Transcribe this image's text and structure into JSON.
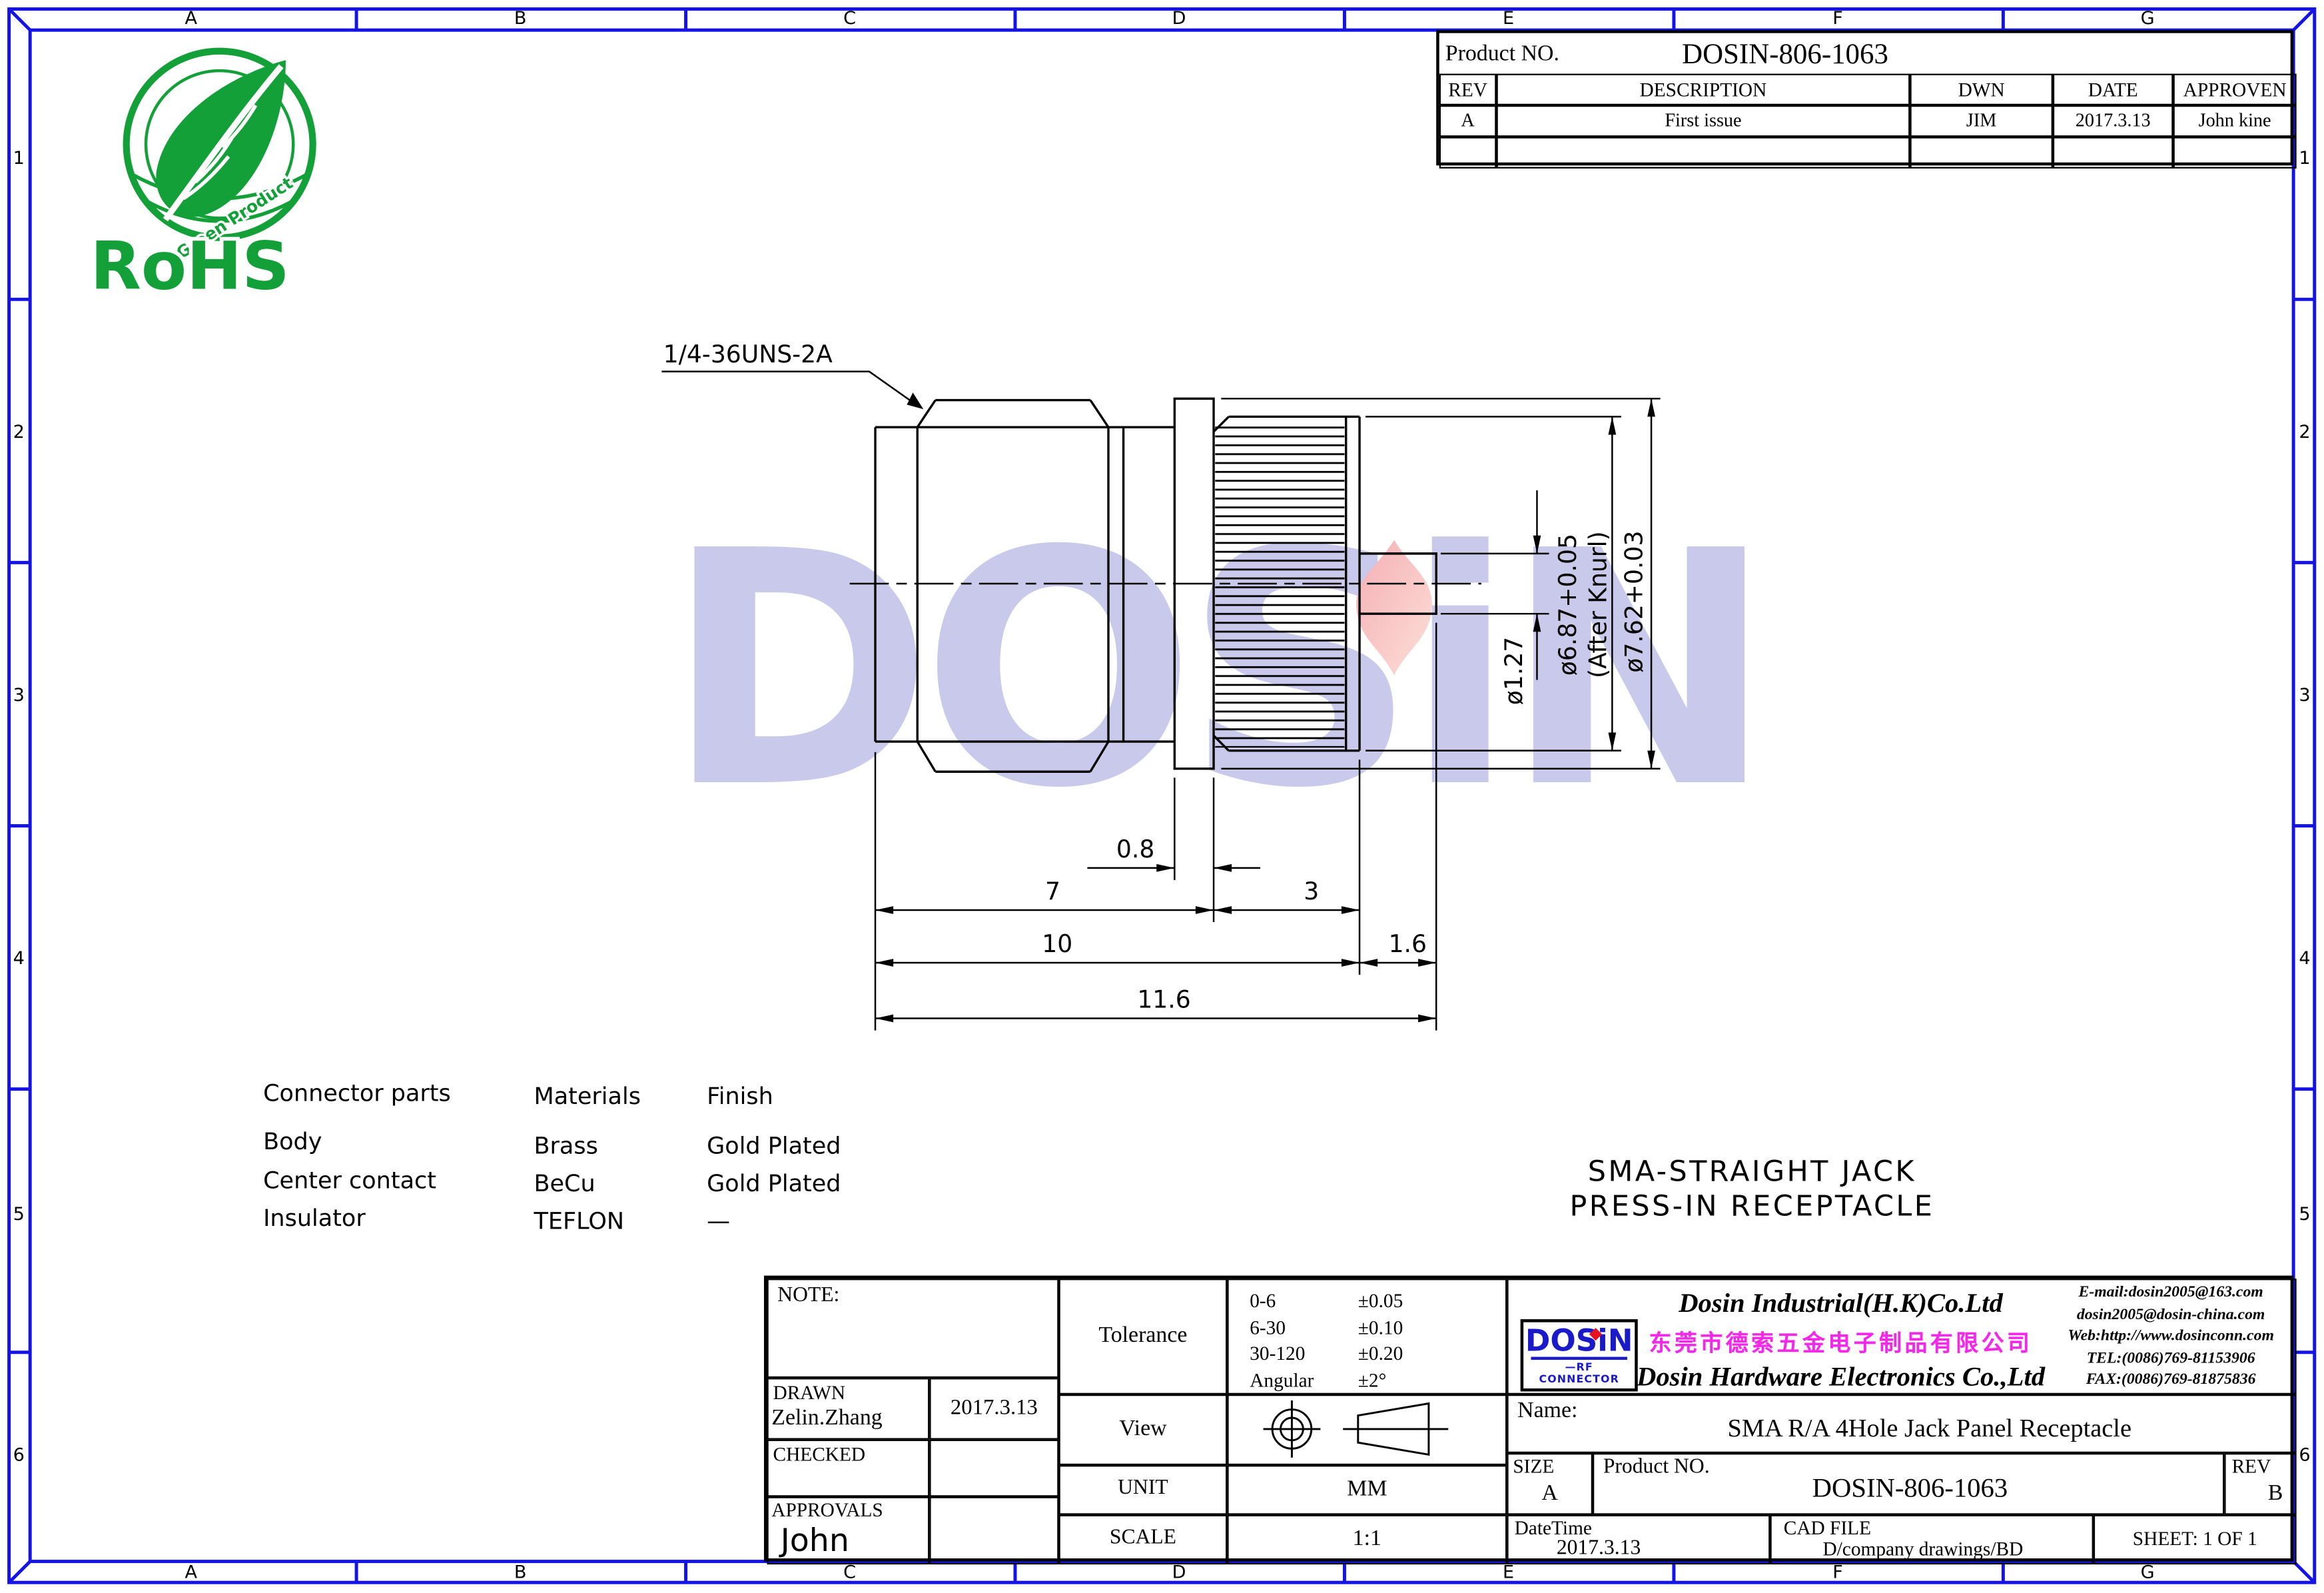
{
  "frame": {
    "cols": [
      "A",
      "B",
      "C",
      "D",
      "E",
      "F",
      "G"
    ],
    "rows": [
      "1",
      "2",
      "3",
      "4",
      "5",
      "6"
    ]
  },
  "rohs": {
    "title": "RoHS",
    "subtitle": "Green Product"
  },
  "rev_table": {
    "product_label": "Product NO.",
    "product_no": "DOSIN-806-1063",
    "col_rev": "REV",
    "col_desc": "DESCRIPTION",
    "col_dwn": "DWN",
    "col_date": "DATE",
    "col_appr": "APPROVEN",
    "row_rev": "A",
    "row_desc": "First issue",
    "row_dwn": "JIM",
    "row_date": "2017.3.13",
    "row_appr": "John kine"
  },
  "drawing": {
    "thread": "1/4-36UNS-2A",
    "dim_0_8": "0.8",
    "dim_7": "7",
    "dim_3": "3",
    "dim_10": "10",
    "dim_1_6": "1.6",
    "dim_11_6": "11.6",
    "dia_pin": "ø1.27",
    "dia_knurl": "ø6.87+0.05",
    "dia_knurl_note": "(After Knurl)",
    "dia_flange": "ø7.62+0.03"
  },
  "watermark": {
    "text": "DOSiN"
  },
  "materials": {
    "h_parts": "Connector parts",
    "h_materials": "Materials",
    "h_finish": "Finish",
    "rows": [
      [
        "Body",
        "Brass",
        "Gold Plated"
      ],
      [
        "Center contact",
        "BeCu",
        "Gold Plated"
      ],
      [
        "Insulator",
        "TEFLON",
        "—"
      ]
    ]
  },
  "title": {
    "line1": "SMA-STRAIGHT JACK",
    "line2": "PRESS-IN RECEPTACLE"
  },
  "tb": {
    "note_label": "NOTE:",
    "drawn_label": "DRAWN",
    "drawn_name": "Zelin.Zhang",
    "drawn_date": "2017.3.13",
    "checked_label": "CHECKED",
    "approvals_label": "APPROVALS",
    "approvals_name": "John",
    "tolerance_label": "Tolerance",
    "tol_rows": [
      [
        "0-6",
        "±0.05"
      ],
      [
        "6-30",
        "±0.10"
      ],
      [
        "30-120",
        "±0.20"
      ],
      [
        "Angular",
        "±2°"
      ]
    ],
    "view_label": "View",
    "unit_label": "UNIT",
    "unit_value": "MM",
    "scale_label": "SCALE",
    "scale_value": "1:1",
    "company": {
      "logo_text": "DOSiN",
      "logo_sub": "—RF CONNECTOR",
      "name_en1": "Dosin Industrial(H.K)Co.Ltd",
      "name_cn": "东莞市德索五金电子制品有限公司",
      "name_en2": "Dosin Hardware Electronics Co.,Ltd",
      "contacts": [
        "E-mail:dosin2005@163.com",
        "dosin2005@dosin-china.com",
        "Web:http://www.dosinconn.com",
        "TEL:(0086)769-81153906",
        "FAX:(0086)769-81875836"
      ]
    },
    "name_label": "Name:",
    "name_value": "SMA R/A 4Hole Jack Panel Receptacle",
    "size_label": "SIZE",
    "size_value": "A",
    "product_label": "Product NO.",
    "product_no": "DOSIN-806-1063",
    "rev_label": "REV",
    "rev_value": "B",
    "datetime_label": "DateTime",
    "datetime_value": "2017.3.13",
    "cadfile_label": "CAD FILE",
    "cadfile_value": "D/company drawings/BD",
    "sheet_value": "SHEET:  1 OF 1"
  }
}
